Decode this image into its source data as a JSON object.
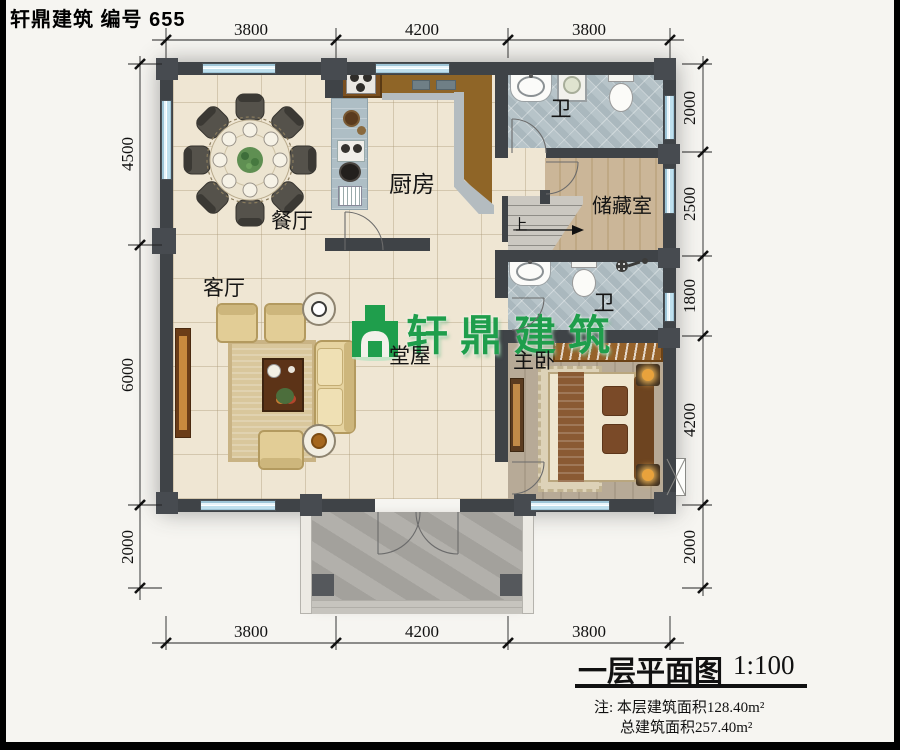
{
  "page": {
    "title": "轩鼎建筑 编号 655"
  },
  "dimensions": {
    "top": [
      "3800",
      "4200",
      "3800"
    ],
    "bottom": [
      "3800",
      "4200",
      "3800"
    ],
    "left": [
      "4500",
      "6000",
      "2000"
    ],
    "right": [
      "2000",
      "2500",
      "1800",
      "4200",
      "2000"
    ]
  },
  "rooms": {
    "dining": "餐厅",
    "kitchen": "厨房",
    "living": "客厅",
    "hall": "堂屋",
    "master_bedroom": "主卧",
    "storage": "储藏室",
    "bath_top": "卫",
    "bath_mid": "卫",
    "stairs_up": "上"
  },
  "logo": {
    "text": "轩鼎建筑"
  },
  "title_block": {
    "name": "一层平面图",
    "scale": "1:100",
    "note_line1": "注: 本层建筑面积128.40m²",
    "note_line2": "总建筑面积257.40m²"
  },
  "colors": {
    "logo_green": "#1f9e4c",
    "wall": "#3f4347",
    "window_blue": "#bfe0ee"
  }
}
